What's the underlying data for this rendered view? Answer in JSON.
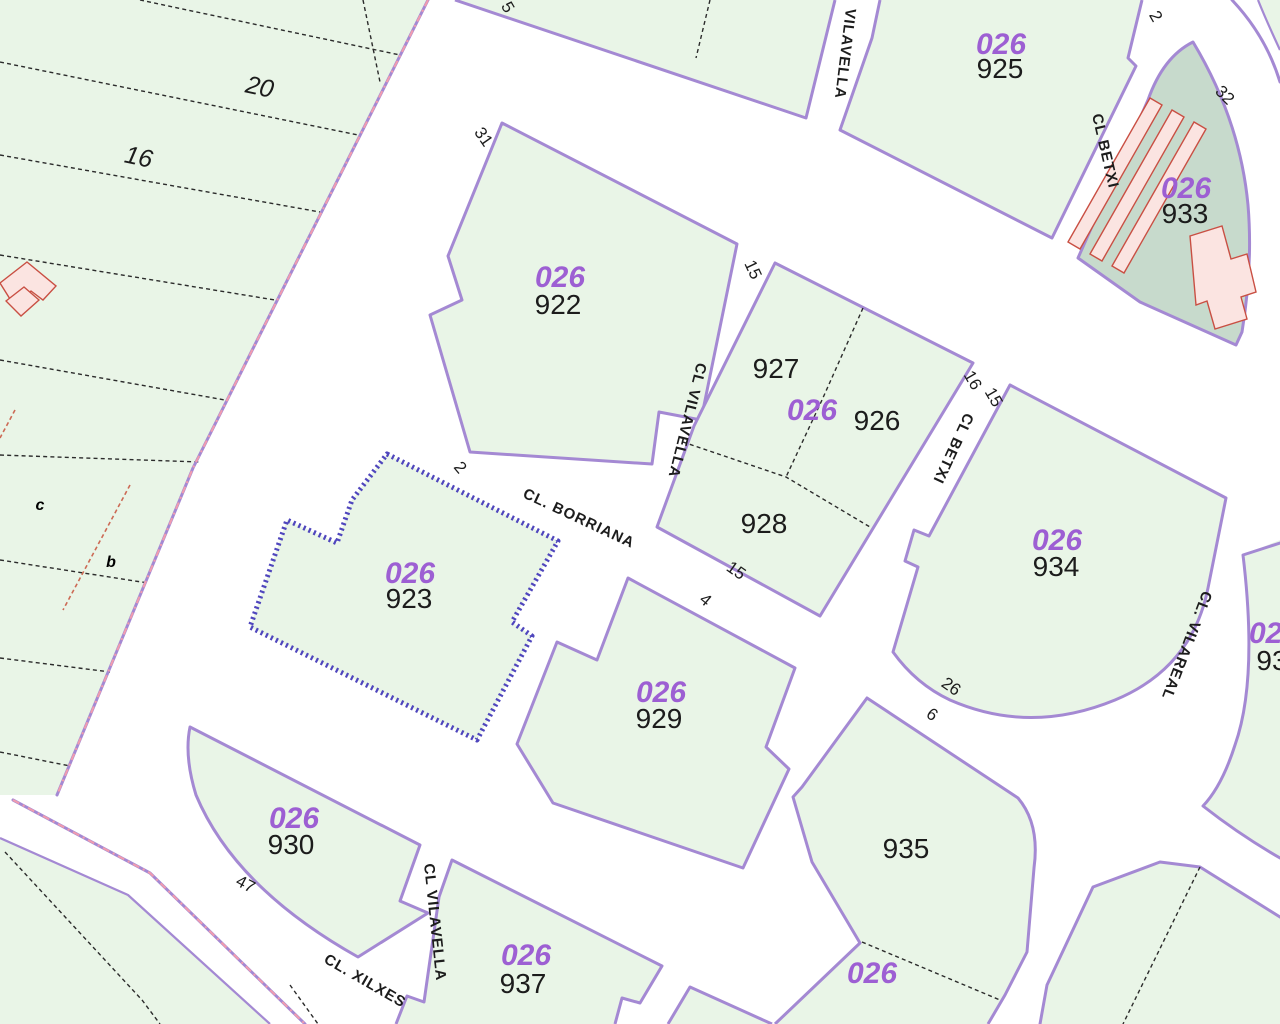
{
  "map": {
    "type": "cadastral-parcel-map",
    "highlighted_parcel": "923",
    "block_code": "026"
  },
  "colors": {
    "parcel-fill": "#e9f5e7",
    "parcel-fill-dark": "#c7dacc",
    "building-fill": "#fbe4e1",
    "building-outline": "#c94f43",
    "boundary-purple": "#a489d3",
    "selected-purple": "#4f46bd",
    "municipal-pink": "#f19cae",
    "block-code-color": "#9d5fd3",
    "number-color": "#1c1c1c",
    "dashed-black": "#2b2b2b",
    "red-dash": "#cc6a55",
    "street-bg": "#ffffff"
  },
  "labels": {
    "block_codes": {
      "class": "block-code",
      "items": [
        {
          "name": "block-code-922",
          "text": "026",
          "x": 560,
          "y": 287
        },
        {
          "name": "block-code-925",
          "text": "026",
          "x": 1001,
          "y": 54
        },
        {
          "name": "block-code-933",
          "text": "026",
          "x": 1186,
          "y": 198
        },
        {
          "name": "block-code-926",
          "text": "026",
          "x": 812,
          "y": 420
        },
        {
          "name": "block-code-923",
          "text": "026",
          "x": 410,
          "y": 583
        },
        {
          "name": "block-code-934",
          "text": "026",
          "x": 1057,
          "y": 550
        },
        {
          "name": "block-code-929",
          "text": "026",
          "x": 661,
          "y": 702
        },
        {
          "name": "block-code-930",
          "text": "026",
          "x": 294,
          "y": 828
        },
        {
          "name": "block-code-937",
          "text": "026",
          "x": 526,
          "y": 965
        },
        {
          "name": "block-code-935-south",
          "text": "026",
          "x": 872,
          "y": 983
        },
        {
          "name": "block-code-east-partial",
          "text": "026",
          "x": 1274,
          "y": 643
        }
      ]
    },
    "parcel_numbers": {
      "class": "parcel-number",
      "items": [
        {
          "name": "parcel-number-922",
          "text": "922",
          "x": 558,
          "y": 314
        },
        {
          "name": "parcel-number-925",
          "text": "925",
          "x": 1000,
          "y": 78
        },
        {
          "name": "parcel-number-933",
          "text": "933",
          "x": 1185,
          "y": 223
        },
        {
          "name": "parcel-number-927",
          "text": "927",
          "x": 776,
          "y": 378
        },
        {
          "name": "parcel-number-926",
          "text": "926",
          "x": 877,
          "y": 430
        },
        {
          "name": "parcel-number-928",
          "text": "928",
          "x": 764,
          "y": 533
        },
        {
          "name": "parcel-number-923",
          "text": "923",
          "x": 409,
          "y": 608
        },
        {
          "name": "parcel-number-934",
          "text": "934",
          "x": 1056,
          "y": 576
        },
        {
          "name": "parcel-number-929",
          "text": "929",
          "x": 659,
          "y": 728
        },
        {
          "name": "parcel-number-930",
          "text": "930",
          "x": 291,
          "y": 854
        },
        {
          "name": "parcel-number-935",
          "text": "935",
          "x": 906,
          "y": 858
        },
        {
          "name": "parcel-number-937",
          "text": "937",
          "x": 523,
          "y": 993
        },
        {
          "name": "parcel-number-east-partial",
          "text": "93",
          "x": 1272,
          "y": 670
        }
      ]
    },
    "strip_numbers": {
      "class": "strip-number",
      "items": [
        {
          "name": "rural-parcel-number-20",
          "text": "20",
          "x": 258,
          "y": 95,
          "rot": 12
        },
        {
          "name": "rural-parcel-number-16",
          "text": "16",
          "x": 137,
          "y": 165,
          "rot": 12
        }
      ]
    },
    "street_names": {
      "class": "street-name",
      "items": [
        {
          "name": "street-name-borriana",
          "text": "CL. BORRIANA",
          "x": 522,
          "y": 497,
          "rot": 25,
          "anchor": "start"
        },
        {
          "name": "street-name-vilavella-top",
          "text": "VILAVELLA",
          "x": 846,
          "y": 8,
          "rot": 97,
          "anchor": "start"
        },
        {
          "name": "street-name-vilavella-mid",
          "text": "CL VILAVELLA",
          "x": 697,
          "y": 362,
          "rot": 104,
          "anchor": "start"
        },
        {
          "name": "street-name-vilavella-south",
          "text": "CL VILAVELLA",
          "x": 424,
          "y": 864,
          "rot": 84,
          "anchor": "start"
        },
        {
          "name": "street-name-betxi-north",
          "text": "CL BETXI",
          "x": 1092,
          "y": 115,
          "rot": 77,
          "anchor": "start"
        },
        {
          "name": "street-name-betxi-mid",
          "text": "CL BETXI",
          "x": 965,
          "y": 412,
          "rot": 115,
          "anchor": "start"
        },
        {
          "name": "street-name-vilareal",
          "text": "CL. VILAREAL",
          "x": 1203,
          "y": 590,
          "rot": 111,
          "anchor": "start"
        },
        {
          "name": "street-name-xilxes",
          "text": "CL. XILXES",
          "x": 323,
          "y": 962,
          "rot": 30,
          "anchor": "start"
        }
      ]
    },
    "street_numbers": {
      "class": "street-number",
      "items": [
        {
          "name": "street-number-31",
          "text": "31",
          "x": 479,
          "y": 140,
          "rot": 55
        },
        {
          "name": "street-number-5",
          "text": "5",
          "x": 503,
          "y": 10,
          "rot": 60
        },
        {
          "name": "street-number-2-a",
          "text": "2",
          "x": 456,
          "y": 471,
          "rot": 50
        },
        {
          "name": "street-number-15-a",
          "text": "15",
          "x": 748,
          "y": 272,
          "rot": 65
        },
        {
          "name": "street-number-15-b",
          "text": "15",
          "x": 733,
          "y": 575,
          "rot": 35
        },
        {
          "name": "street-number-4",
          "text": "4",
          "x": 702,
          "y": 604,
          "rot": 40
        },
        {
          "name": "street-number-16-a",
          "text": "16",
          "x": 968,
          "y": 383,
          "rot": 60
        },
        {
          "name": "street-number-15-c",
          "text": "15",
          "x": 989,
          "y": 400,
          "rot": 60
        },
        {
          "name": "street-number-2-b",
          "text": "2",
          "x": 1151,
          "y": 19,
          "rot": 60
        },
        {
          "name": "street-number-32",
          "text": "32",
          "x": 1221,
          "y": 99,
          "rot": 45
        },
        {
          "name": "street-number-26",
          "text": "26",
          "x": 948,
          "y": 691,
          "rot": 35
        },
        {
          "name": "street-number-6",
          "text": "6",
          "x": 929,
          "y": 719,
          "rot": 35
        },
        {
          "name": "street-number-47",
          "text": "47",
          "x": 243,
          "y": 889,
          "rot": 28
        }
      ]
    },
    "subparcel_letters": {
      "class": "subparcel-letter",
      "items": [
        {
          "name": "subparcel-letter-c",
          "text": "c",
          "x": 40,
          "y": 510
        },
        {
          "name": "subparcel-letter-b",
          "text": "b",
          "x": 111,
          "y": 567
        }
      ]
    }
  }
}
